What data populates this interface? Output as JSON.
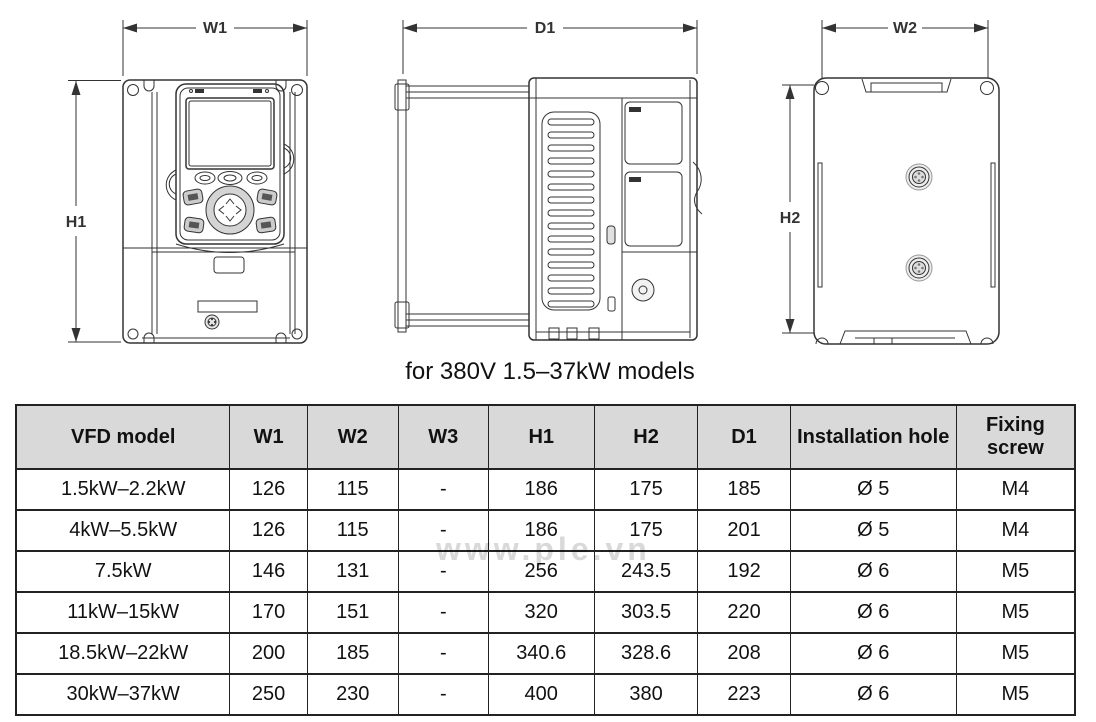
{
  "drawings": {
    "front_view": {
      "width_label": "W1",
      "height_label": "H1"
    },
    "side_view": {
      "depth_label": "D1"
    },
    "back_view": {
      "width_label": "W2",
      "height_label": "H2"
    },
    "caption": "for 380V 1.5–37kW models"
  },
  "watermark": {
    "text": "www.ple.vn"
  },
  "table": {
    "headers": [
      "VFD model",
      "W1",
      "W2",
      "W3",
      "H1",
      "H2",
      "D1",
      "Installation hole",
      "Fixing screw"
    ],
    "rows": [
      [
        "1.5kW–2.2kW",
        "126",
        "115",
        "-",
        "186",
        "175",
        "185",
        "Ø 5",
        "M4"
      ],
      [
        "4kW–5.5kW",
        "126",
        "115",
        "-",
        "186",
        "175",
        "201",
        "Ø 5",
        "M4"
      ],
      [
        "7.5kW",
        "146",
        "131",
        "-",
        "256",
        "243.5",
        "192",
        "Ø 6",
        "M5"
      ],
      [
        "11kW–15kW",
        "170",
        "151",
        "-",
        "320",
        "303.5",
        "220",
        "Ø 6",
        "M5"
      ],
      [
        "18.5kW–22kW",
        "200",
        "185",
        "-",
        "340.6",
        "328.6",
        "208",
        "Ø 6",
        "M5"
      ],
      [
        "30kW–37kW",
        "250",
        "230",
        "-",
        "400",
        "380",
        "223",
        "Ø 6",
        "M5"
      ]
    ]
  },
  "colors": {
    "line": "#333333",
    "header_bg": "#d9d9d9",
    "text": "#111111",
    "watermark": "#d9d9d9",
    "bg": "#ffffff"
  }
}
